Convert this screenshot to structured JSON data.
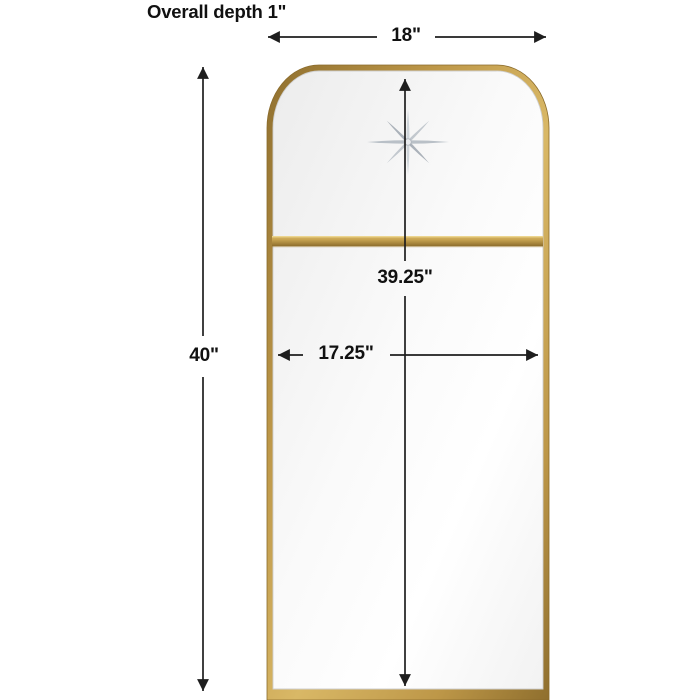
{
  "title": "Overall depth 1\"",
  "diagram": {
    "type": "product-dimension-drawing",
    "subject": "rectangular wall mirror with scooped pagoda top, gold metal frame, etched star medallion and horizontal divider bar",
    "dimensions": {
      "overall_depth": "1\"",
      "overall_width": "18\"",
      "overall_height": "40\"",
      "inner_height": "39.25\"",
      "inner_width": "17.25\""
    },
    "labels": {
      "depth": "Overall depth 1\"",
      "width": "18\"",
      "height": "40\"",
      "inner_height": "39.25\"",
      "inner_width": "17.25\""
    },
    "icons": [
      "star-icon"
    ],
    "colors": {
      "background": "#ffffff",
      "frame_gold": "#bd9748",
      "frame_gold_dark": "#8f6f2e",
      "frame_gold_light": "#d9b866",
      "divider_gold": "#c8a452",
      "mirror_light": "#ffffff",
      "mirror_shade": "#ececec",
      "star_silver": "#b9c0c7",
      "dimension_line": "#1e1e1e"
    }
  }
}
